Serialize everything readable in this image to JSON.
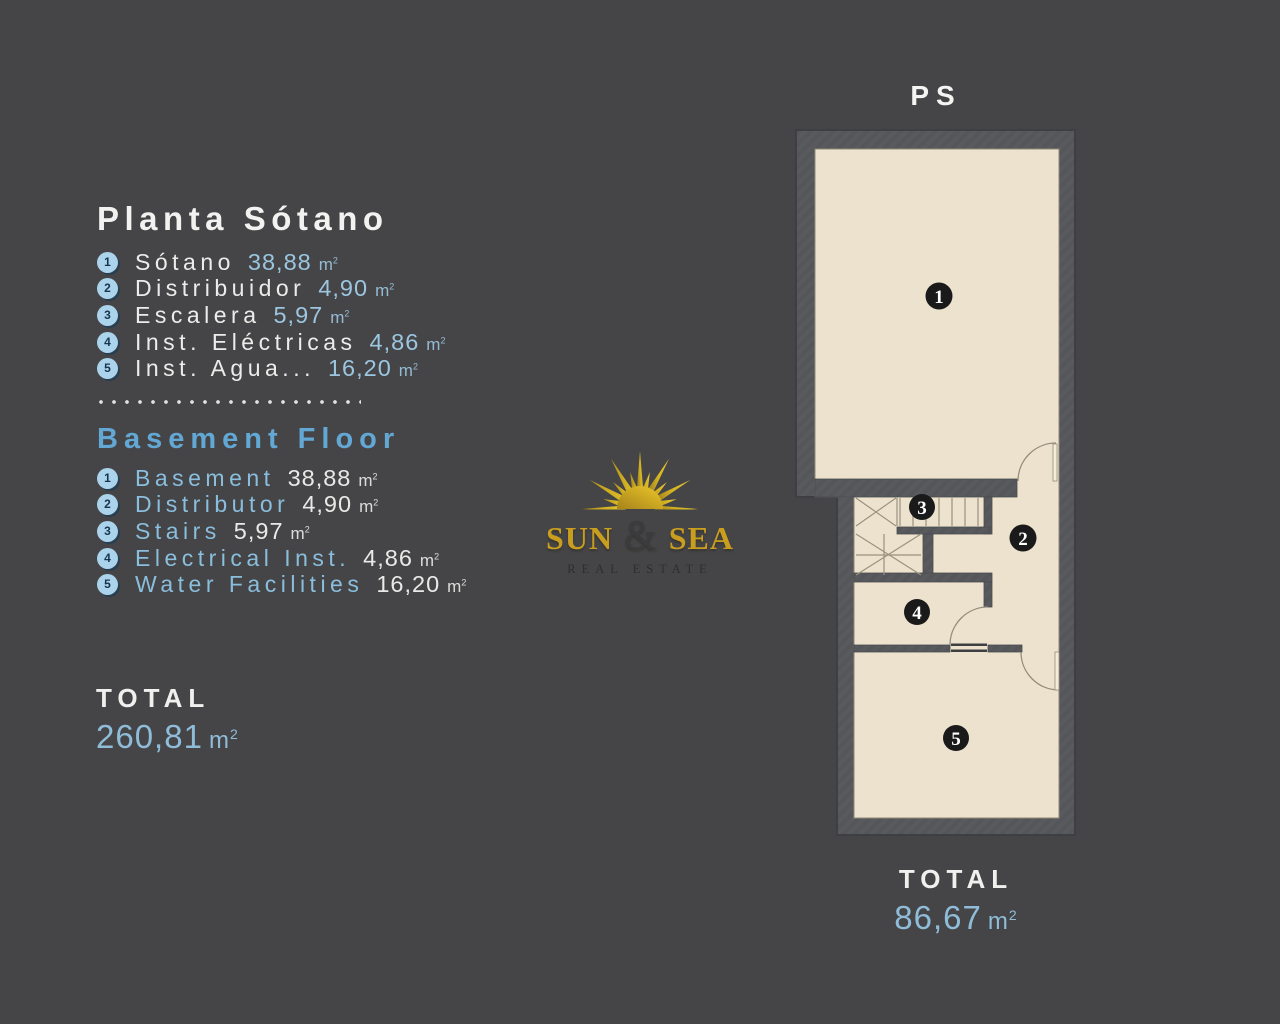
{
  "colors": {
    "background": "#454547",
    "wall": "#58585c",
    "floor": "#ece2cd",
    "accent_blue_heading": "#63a8d4",
    "accent_blue_value": "#9cc6e0",
    "badge_blue": "#abd3ec",
    "logo_gold": "#c99e1f",
    "text_white": "#f2f2f0"
  },
  "shared": {
    "unit": "m",
    "unit_sup": "2"
  },
  "left_panel": {
    "spanish": {
      "title": "Planta Sótano",
      "items": [
        {
          "num": "1",
          "label": "Sótano",
          "value": "38,88"
        },
        {
          "num": "2",
          "label": "Distribuidor",
          "value": "4,90"
        },
        {
          "num": "3",
          "label": "Escalera",
          "value": "5,97"
        },
        {
          "num": "4",
          "label": "Inst. Eléctricas",
          "value": "4,86"
        },
        {
          "num": "5",
          "label": "Inst. Agua...",
          "value": "16,20"
        }
      ]
    },
    "english": {
      "title": "Basement Floor",
      "items": [
        {
          "num": "1",
          "label": "Basement",
          "value": "38,88"
        },
        {
          "num": "2",
          "label": "Distributor",
          "value": "4,90"
        },
        {
          "num": "3",
          "label": "Stairs",
          "value": "5,97"
        },
        {
          "num": "4",
          "label": "Electrical Inst.",
          "value": "4,86"
        },
        {
          "num": "5",
          "label": "Water Facilities",
          "value": "16,20"
        }
      ]
    },
    "total": {
      "label": "TOTAL",
      "value": "260,81"
    }
  },
  "logo": {
    "word1": "SUN",
    "ampersand": "&",
    "word2": "SEA",
    "tagline": "REAL ESTATE"
  },
  "floor_plan": {
    "label": "PS",
    "rooms": [
      {
        "number": "1"
      },
      {
        "number": "2"
      },
      {
        "number": "3"
      },
      {
        "number": "4"
      },
      {
        "number": "5"
      }
    ],
    "total": {
      "label": "TOTAL",
      "value": "86,67"
    }
  }
}
